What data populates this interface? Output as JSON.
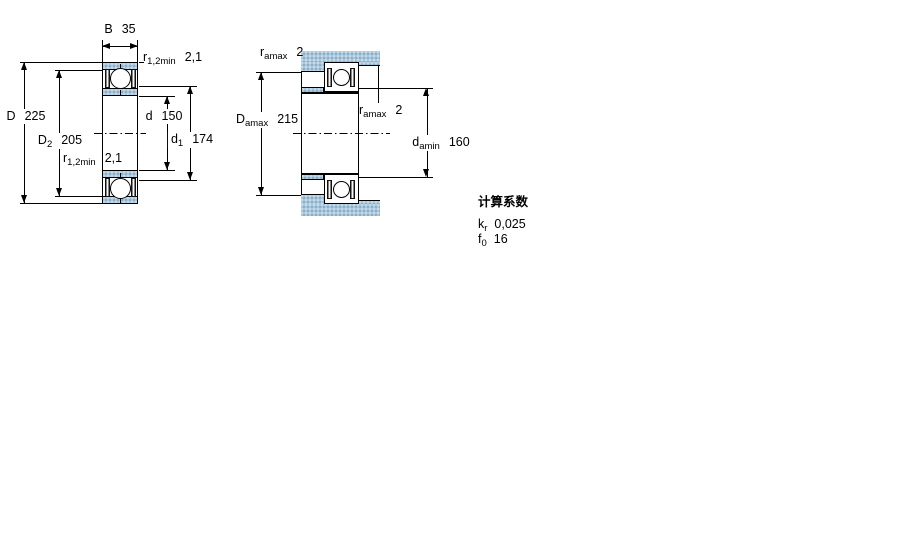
{
  "colors": {
    "steel_blue": "#aac7db",
    "line": "#000000"
  },
  "figure_left": {
    "B": {
      "symbol": "B",
      "value": "35"
    },
    "r_top": {
      "symbol": "r",
      "sub": "1,2min",
      "value": "2,1"
    },
    "D": {
      "symbol": "D",
      "value": "225"
    },
    "D2": {
      "symbol": "D",
      "sub": "2",
      "value": "205"
    },
    "r_bottom": {
      "symbol": "r",
      "sub": "1,2min",
      "value": "2,1"
    },
    "d": {
      "symbol": "d",
      "value": "150"
    },
    "d1": {
      "symbol": "d",
      "sub": "1",
      "value": "174"
    }
  },
  "figure_right": {
    "r_amax_top": {
      "symbol": "r",
      "sub": "amax",
      "value": "2"
    },
    "D_amax": {
      "symbol": "D",
      "sub": "amax",
      "value": "215"
    },
    "r_amax_mid": {
      "symbol": "r",
      "sub": "amax",
      "value": "2"
    },
    "d_amin": {
      "symbol": "d",
      "sub": "amin",
      "value": "160"
    }
  },
  "calculation_factors": {
    "title": "计算系数",
    "k_r": {
      "symbol": "k",
      "sub": "r",
      "value": "0,025"
    },
    "f_0": {
      "symbol": "f",
      "sub": "0",
      "value": "16"
    }
  }
}
